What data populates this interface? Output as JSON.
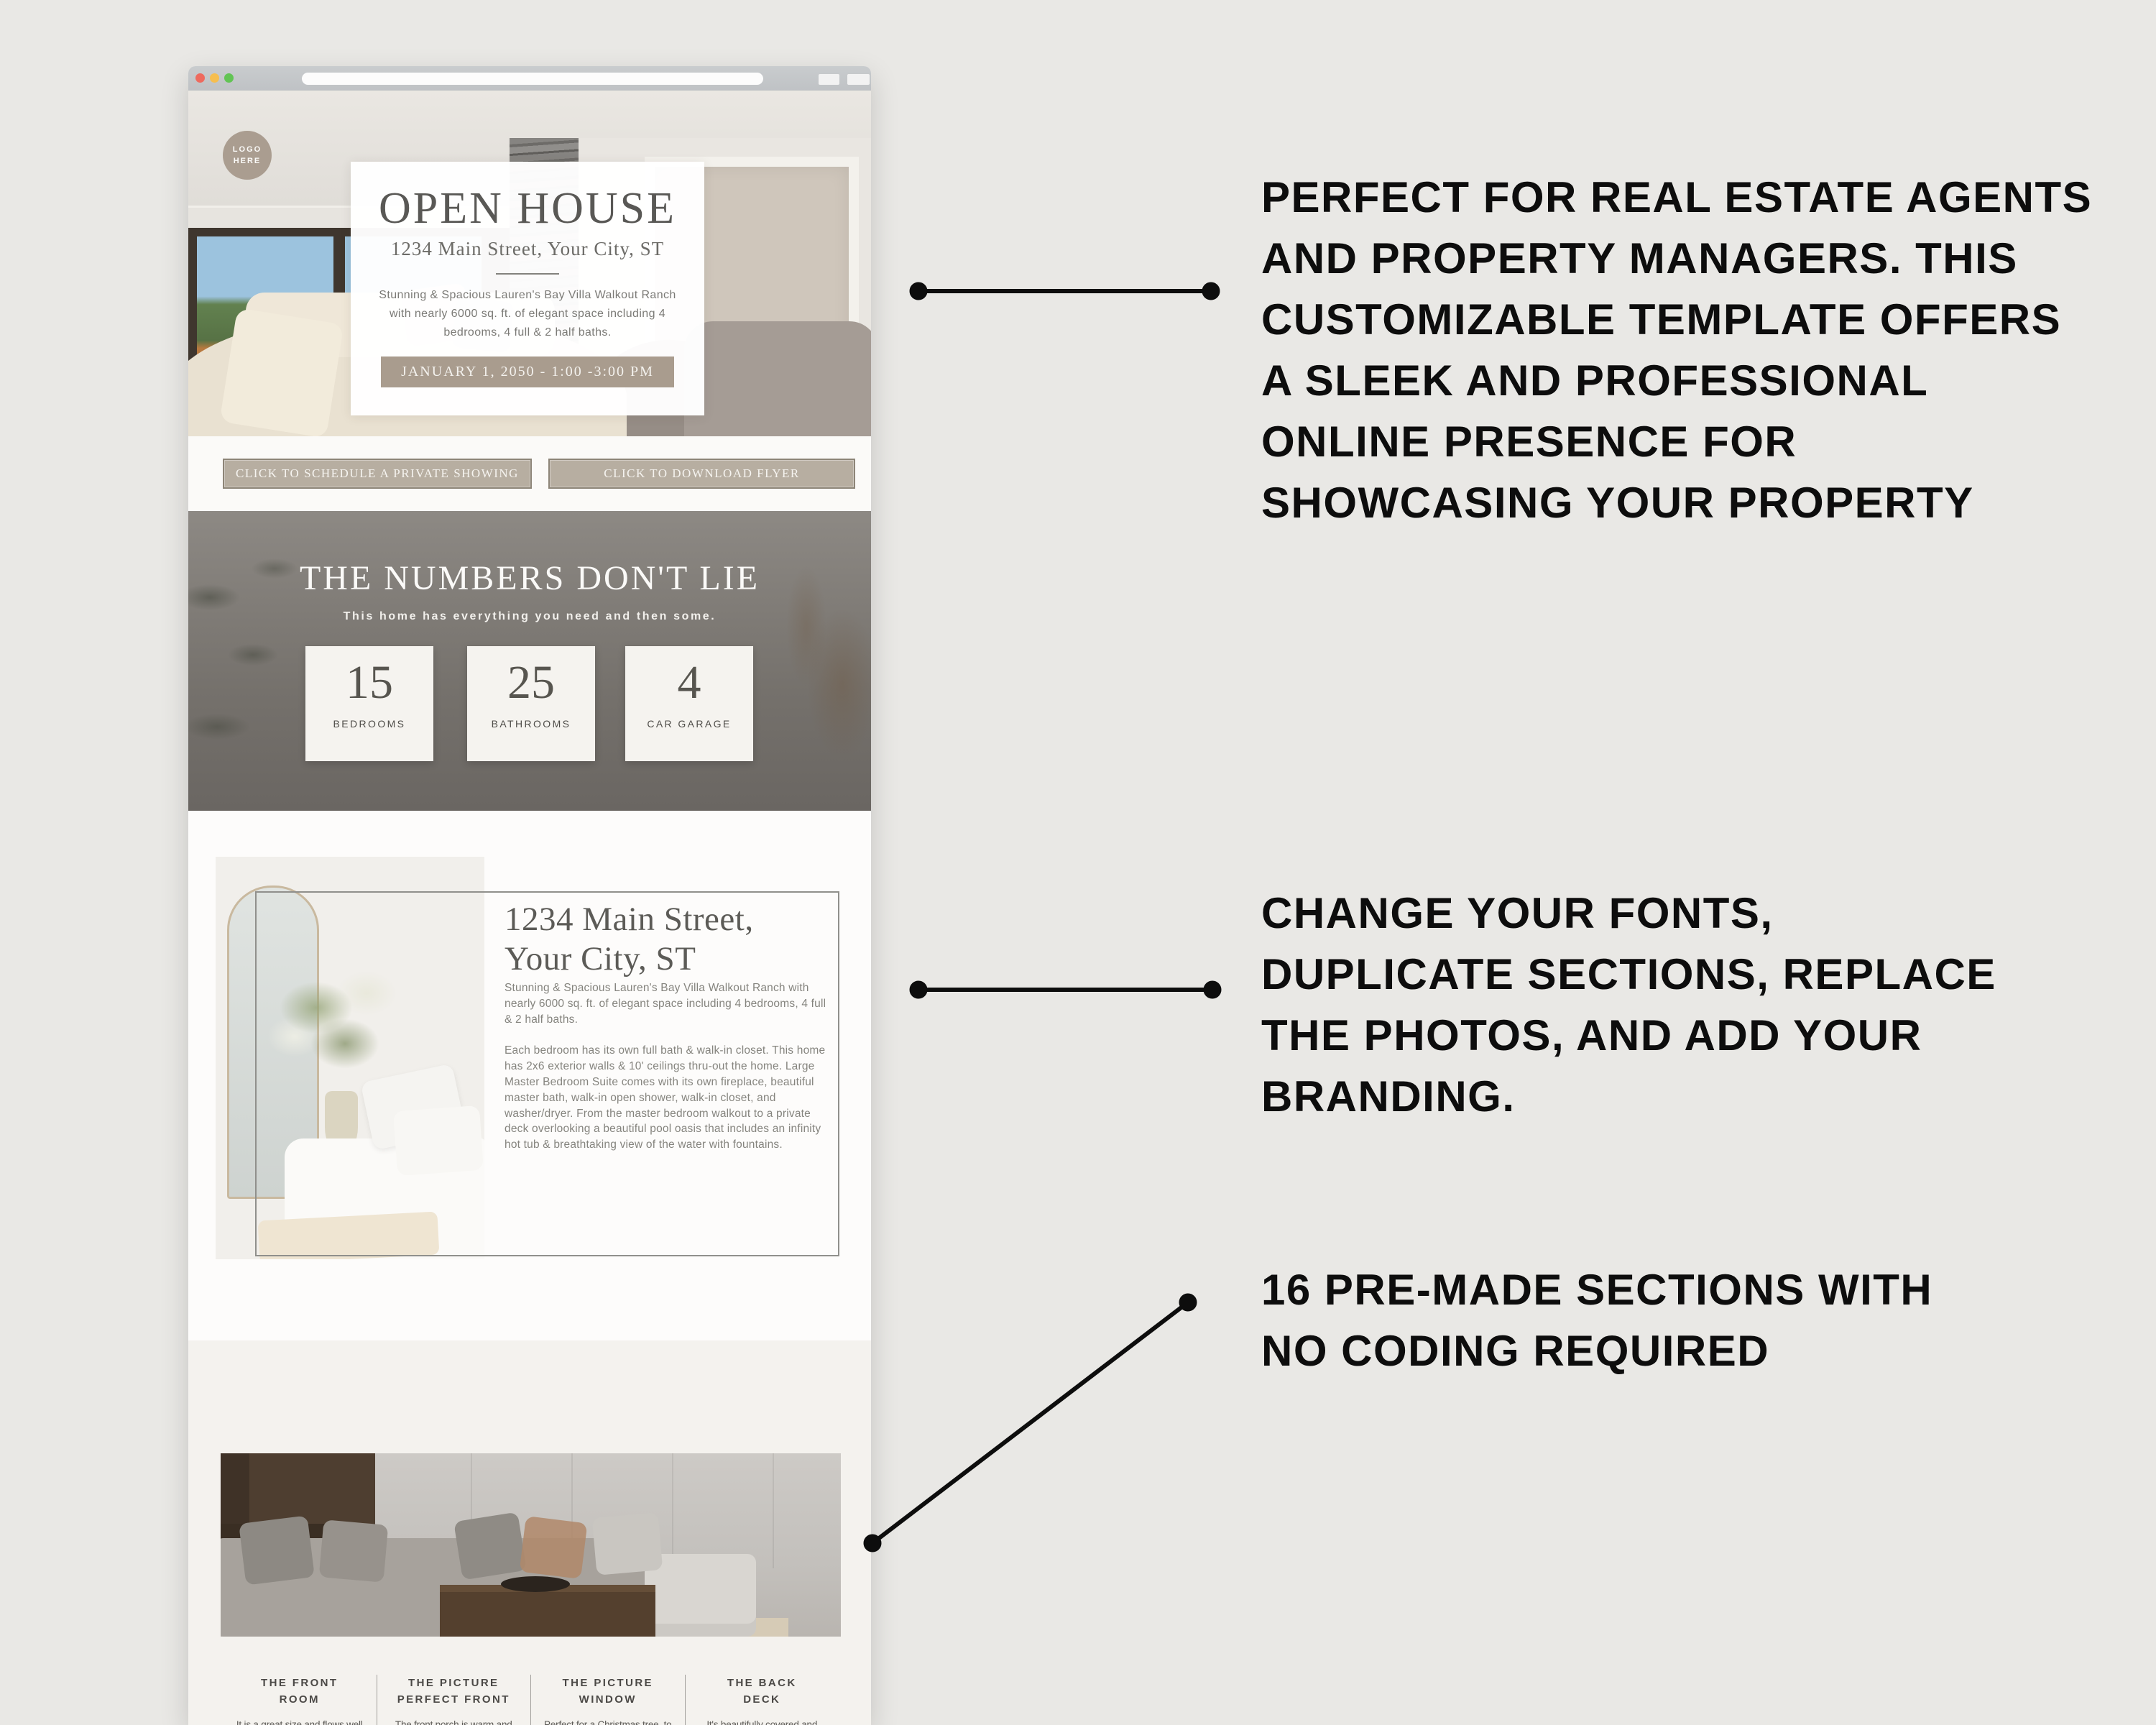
{
  "browser": {
    "window": "template-preview-browser",
    "traffic_light_colors": [
      "#ee6a5e",
      "#f6be4f",
      "#62c454"
    ]
  },
  "hero": {
    "logo_text": "LOGO\nHERE",
    "card": {
      "title": "OPEN HOUSE",
      "address": "1234 Main Street, Your City, ST",
      "description": "Stunning & Spacious Lauren's Bay Villa Walkout Ranch with nearly 6000 sq. ft. of elegant space including 4 bedrooms, 4 full & 2 half baths.",
      "banner": "JANUARY 1, 2050 - 1:00 -3:00 PM",
      "banner_bg": "#a99c8e"
    }
  },
  "buttons": {
    "schedule": "CLICK TO SCHEDULE A PRIVATE SHOWING",
    "download": "CLICK TO DOWNLOAD FLYER",
    "bg": "#b7aea1"
  },
  "numbers": {
    "title": "THE NUMBERS DON'T LIE",
    "subtitle": "This home has everything you need and then some.",
    "stats": [
      {
        "value": "15",
        "label": "BEDROOMS"
      },
      {
        "value": "25",
        "label": "BATHROOMS"
      },
      {
        "value": "4",
        "label": "CAR GARAGE"
      }
    ]
  },
  "detail": {
    "heading_line1": "1234 Main Street,",
    "heading_line2": "Your City, ST",
    "paragraph1": "Stunning & Spacious Lauren's Bay Villa Walkout Ranch with nearly 6000 sq. ft. of elegant space including 4 bedrooms, 4 full & 2 half baths.",
    "paragraph2": "Each bedroom has its own full bath & walk-in closet. This home has 2x6 exterior walls & 10' ceilings thru-out the home. Large Master Bedroom Suite comes with its own fireplace, beautiful master bath, walk-in open shower, walk-in closet, and washer/dryer. From the master bedroom walkout to a private deck overlooking a beautiful pool oasis that includes an infinity hot tub & breathtaking view of the water with fountains."
  },
  "bottom": {
    "columns": [
      {
        "title_line1": "THE FRONT",
        "title_line2": "ROOM",
        "body": "It is a great size and flows well into one of two dining areas. It'll be great to have people over to play games and celebrate life events."
      },
      {
        "title_line1": "THE PICTURE",
        "title_line2": "PERFECT FRONT",
        "body": "The front porch is warm and welcoming. You will want to spend hours enjoying the cozy porch swing and the huge shade tree."
      },
      {
        "title_line1": "THE PICTURE",
        "title_line2": "WINDOW",
        "body": "Perfect for a Christmas tree, to sit and watch a rain storm, or to just let in all the beautiful natural light."
      },
      {
        "title_line1": "THE BACK",
        "title_line2": "DECK",
        "body": "It's beautifully covered and looks out at the large backyard. Enjoying cookouts will be on your to-do list."
      }
    ]
  },
  "annotations": {
    "block1_lines": [
      "PERFECT FOR REAL ESTATE AGENTS",
      "AND PROPERTY MANAGERS. THIS",
      "CUSTOMIZABLE TEMPLATE OFFERS",
      "A SLEEK AND PROFESSIONAL",
      "ONLINE PRESENCE FOR",
      "SHOWCASING YOUR PROPERTY"
    ],
    "block2_lines": [
      "CHANGE YOUR FONTS,",
      "DUPLICATE SECTIONS,  REPLACE",
      "THE PHOTOS, AND ADD YOUR",
      "BRANDING."
    ],
    "block3_lines": [
      "16 PRE-MADE SECTIONS WITH",
      "NO CODING REQUIRED"
    ],
    "text_color": "#0d0d0d"
  }
}
